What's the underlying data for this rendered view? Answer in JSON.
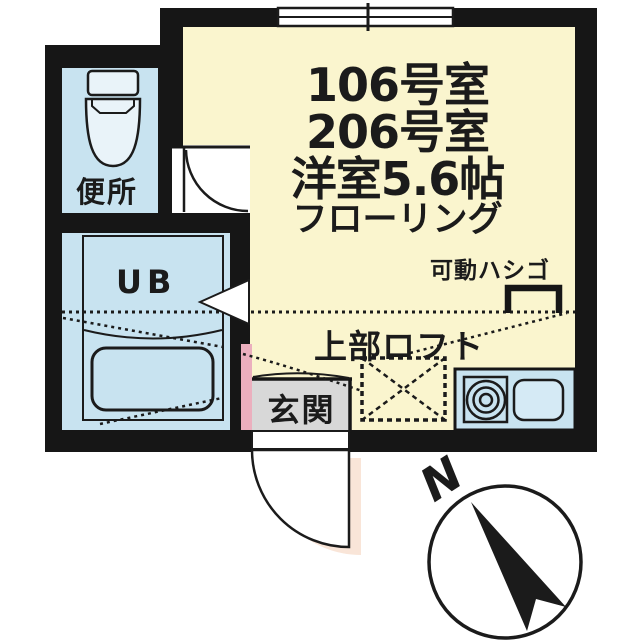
{
  "plan": {
    "title_lines": [
      "106号室",
      "206号室",
      "洋室5.6帖",
      "フローリング"
    ],
    "labels": {
      "movable_ladder": "可動ハシゴ",
      "upper_loft": "上部ロフト",
      "entrance": "玄関",
      "toilet": "便所",
      "unit_bath": "UB"
    },
    "compass": {
      "north": "N"
    },
    "colors": {
      "room_yellow": "#FAF5CE",
      "wet_area_blue": "#C8E3F0",
      "wall_black": "#161616",
      "entrance_grey": "#D8D8D8",
      "accent_pink": "#EBAFBE",
      "door_shadow_peach": "#F9E5D8"
    }
  }
}
